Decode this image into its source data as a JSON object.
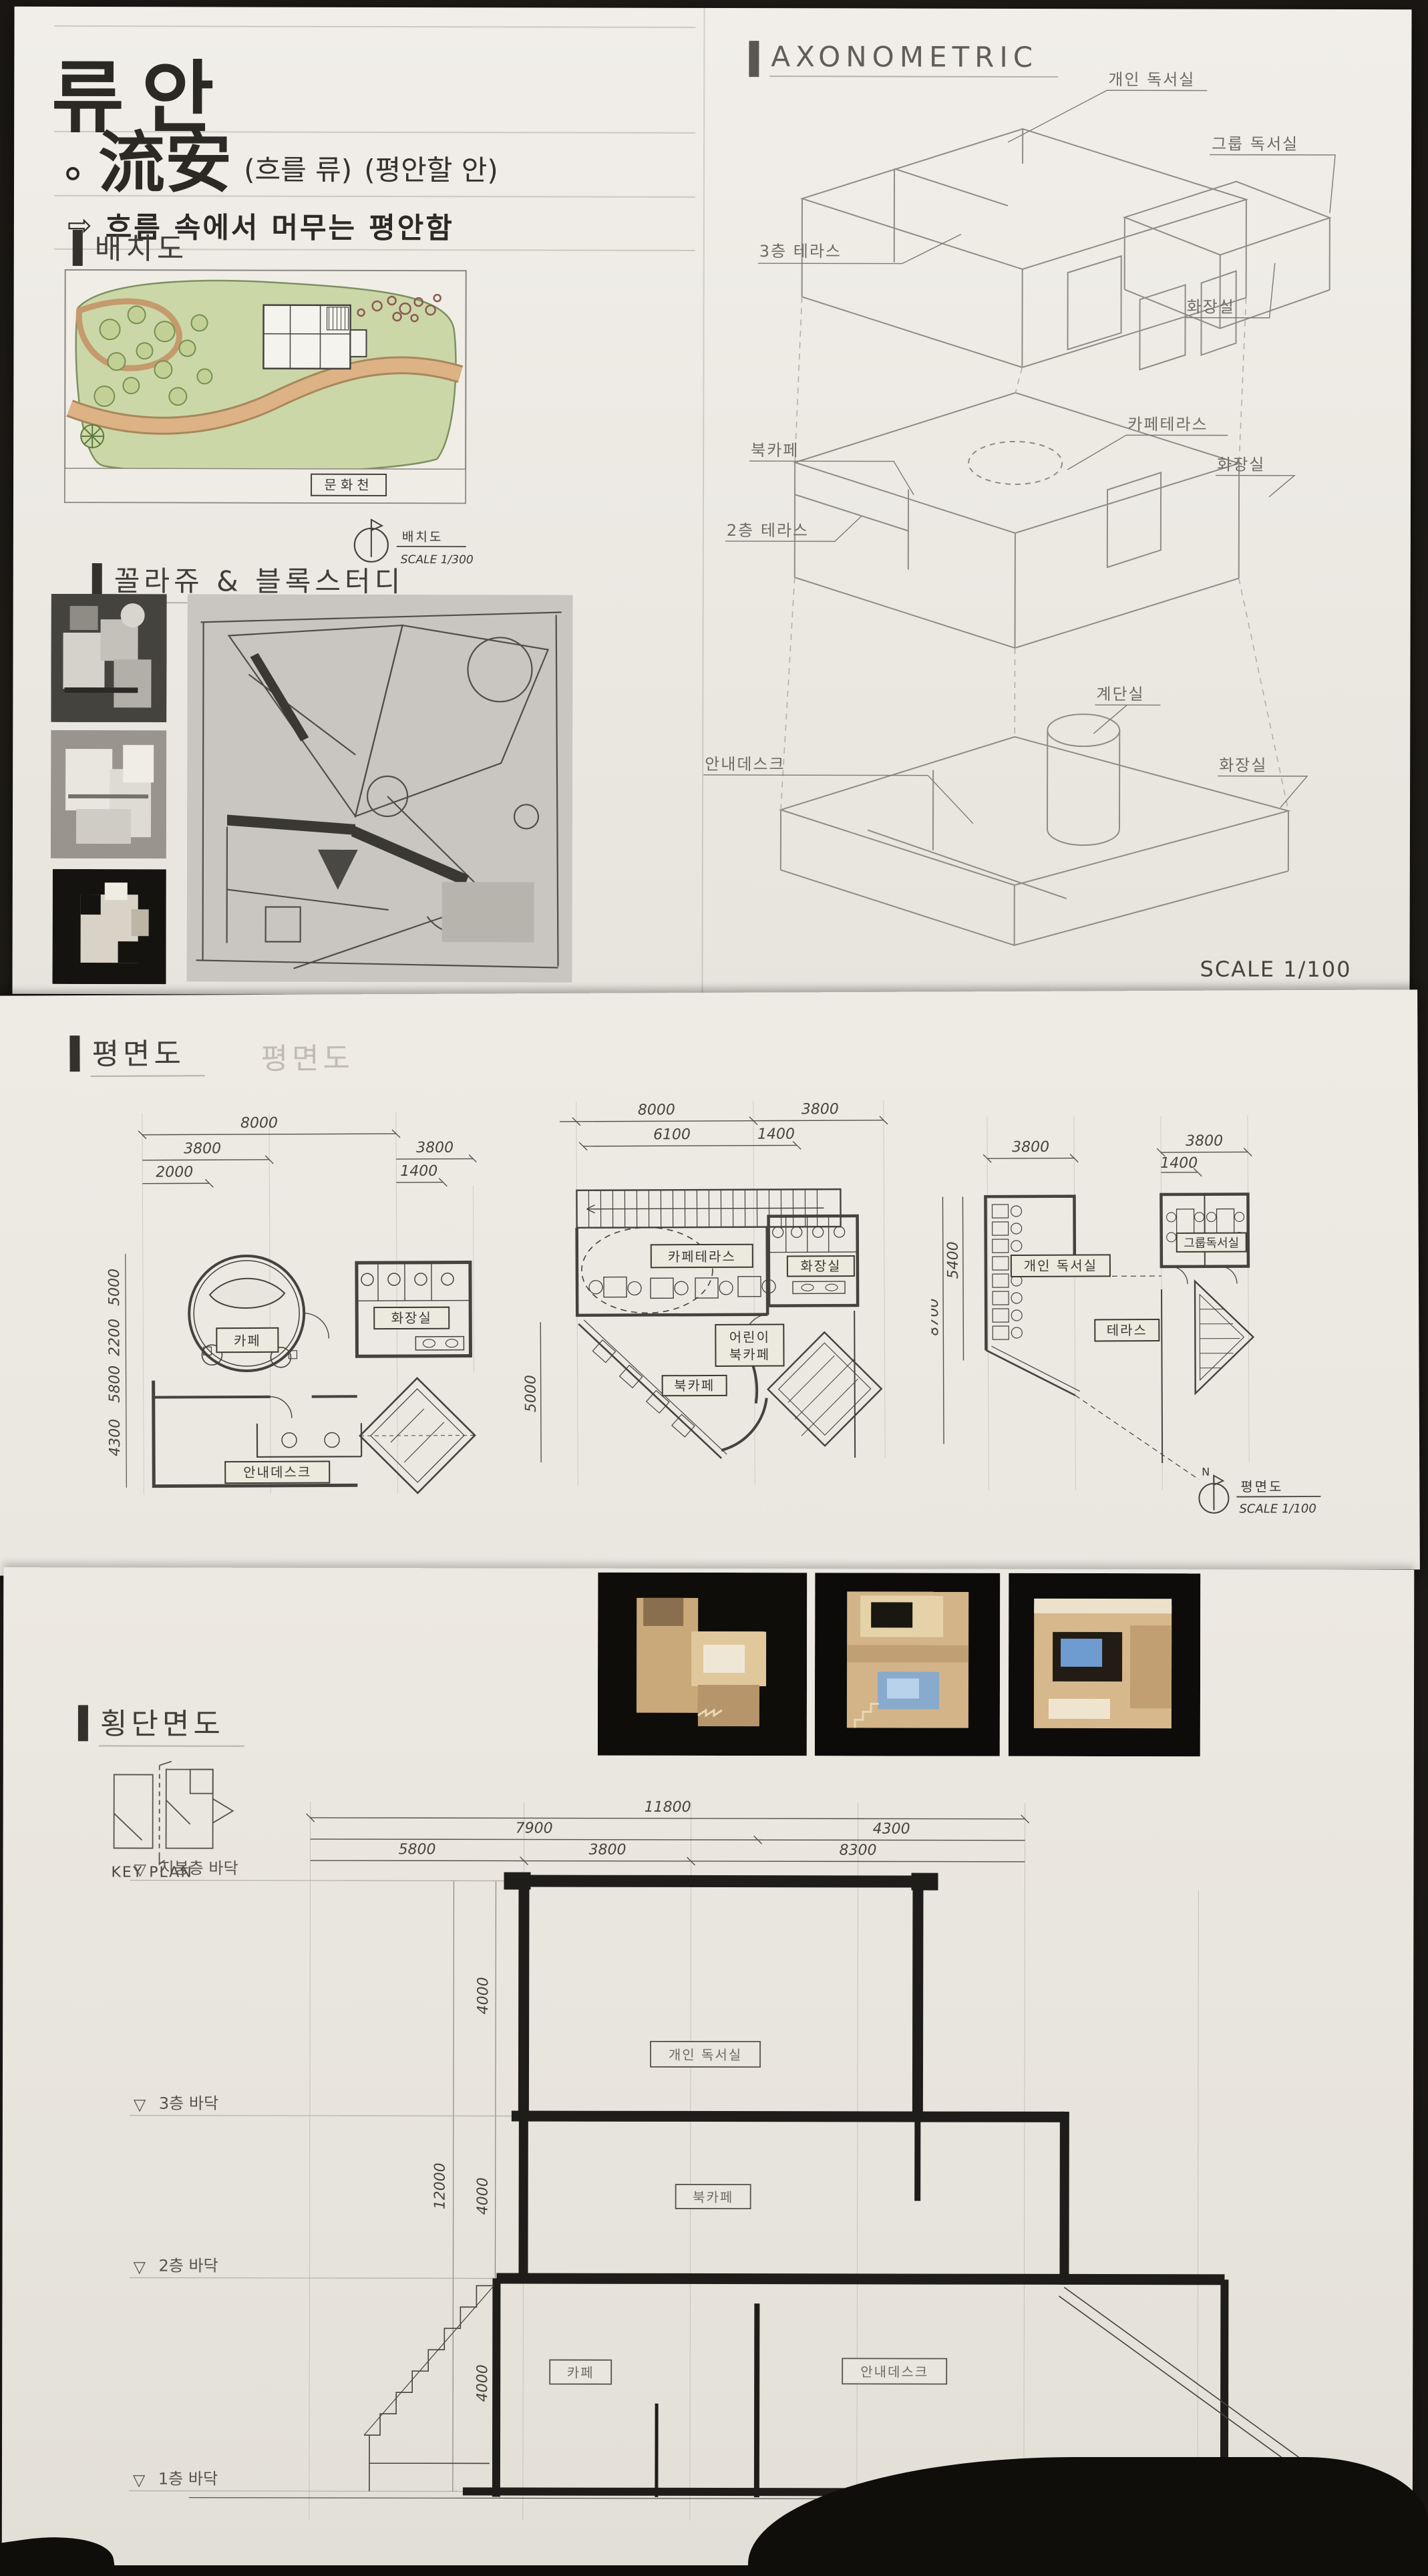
{
  "palette": {
    "board_paper": "#ece9e3",
    "ink_black": "#2e2c28",
    "pencil_gray": "#8f8c86",
    "site_green": "#ccd7a8",
    "site_road_tan": "#d9ac7a",
    "model_wood": "#d3b488",
    "model_glow_blue": "#7fa8d4",
    "photo_background": "#0e0d0a"
  },
  "title_block": {
    "main_title": "류안",
    "bullet": "∘",
    "hanja": "流安",
    "note1": "(흐를 류)",
    "note2": "(평안할 안)",
    "arrow": "⇨",
    "tagline": "흐름 속에서 머무는 평안함"
  },
  "site": {
    "header": "배치도",
    "stream_label": "문화천",
    "north": "N",
    "caption_name": "배치도",
    "caption_scale": "SCALE 1/300"
  },
  "collage": {
    "header": "꼴라쥬 & 블록스터디"
  },
  "axon": {
    "header": "AXONOMETRIC",
    "scale": "SCALE 1/100",
    "labels": {
      "personal": "개인 독서실",
      "group": "그룹 독서실",
      "toilet3": "화장실",
      "terrace3": "3층 테라스",
      "cafeterrace": "카페테라스",
      "toilet2": "화장실",
      "bookcafe": "북카페",
      "terrace2": "2층 테라스",
      "stair": "계단실",
      "infodesk": "안내데스크",
      "toilet1": "화장실"
    }
  },
  "plans": {
    "header": "평면도",
    "ghost": "평면도",
    "p1": {
      "d8000": "8000",
      "d3800a": "3800",
      "d3800b": "3800",
      "d2000": "2000",
      "d1400": "1400",
      "left": [
        "5000",
        "2200",
        "5800",
        "4300"
      ],
      "cafe": "카페",
      "toilet": "화장실",
      "infodesk": "안내데스크"
    },
    "p2": {
      "d8000": "8000",
      "d3800": "3800",
      "d6100": "6100",
      "d1400": "1400",
      "left": [
        "5000"
      ],
      "cafeterrace": "카페테라스",
      "toilet": "화장실",
      "kids1": "어린이",
      "kids2": "북카페",
      "bookcafe": "북카페"
    },
    "p3": {
      "d3800a": "3800",
      "d3800b": "3800",
      "d1400": "1400",
      "left": [
        "5400",
        "8700"
      ],
      "personal": "개인 독서실",
      "group": "그룹독서실",
      "terrace": "테라스"
    },
    "north": "N",
    "caption_name": "평면도",
    "caption_scale": "SCALE 1/100"
  },
  "section": {
    "header": "횡단면도",
    "keyplan": "KEY PLAN",
    "d11800": "11800",
    "d7900": "7900",
    "d4300": "4300",
    "d5800": "5800",
    "d3800": "3800",
    "d8300": "8300",
    "v4000a": "4000",
    "v4000b": "4000",
    "v4000c": "4000",
    "v12000": "12000",
    "marker": "▽",
    "levels": [
      "지붕층 바닥",
      "3층 바닥",
      "2층 바닥",
      "1층 바닥"
    ],
    "rooms": {
      "personal": "개인 독서실",
      "bookcafe": "북카페",
      "cafe": "카페",
      "infodesk": "안내데스크"
    }
  }
}
